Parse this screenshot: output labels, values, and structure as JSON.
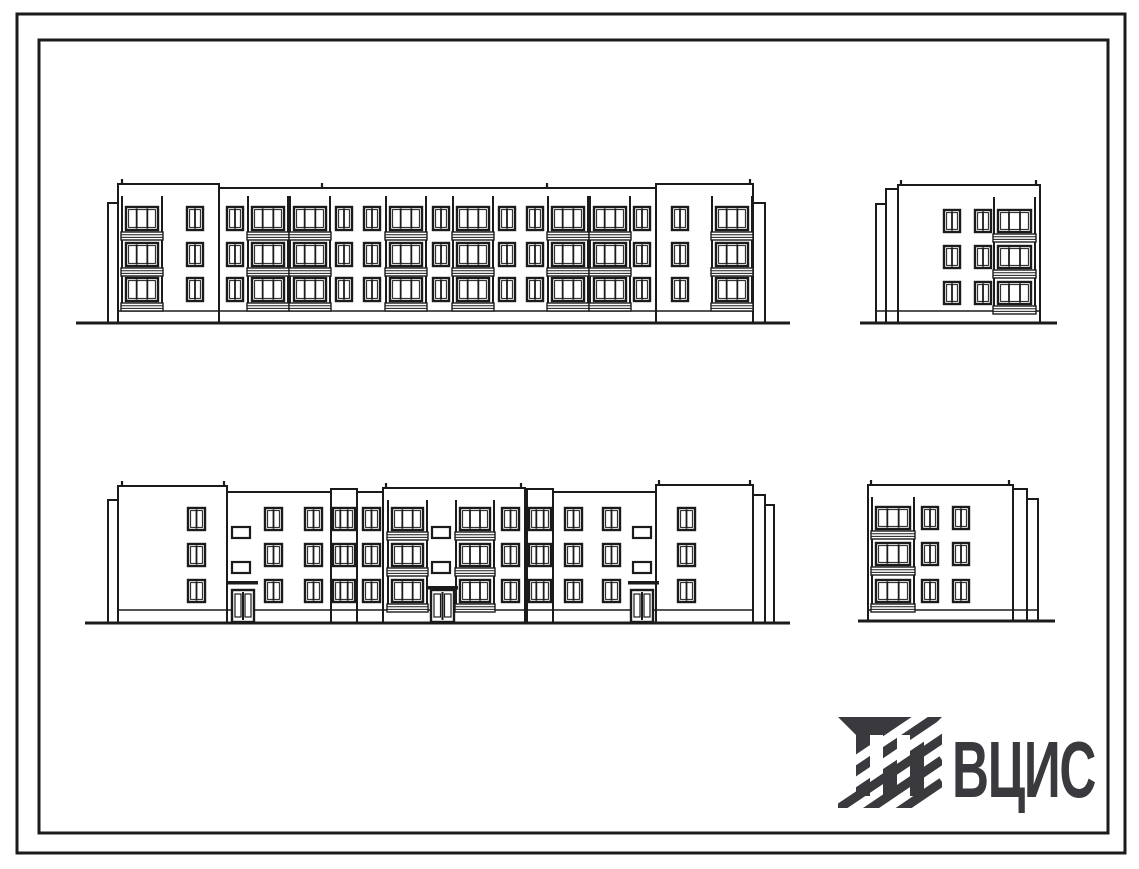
{
  "sheet": {
    "width": 1139,
    "height": 869,
    "background": "#ffffff"
  },
  "frame": {
    "outer": {
      "x": 17,
      "y": 14,
      "w": 1108,
      "h": 839,
      "stroke_width": 3
    },
    "inner": {
      "x": 39,
      "y": 40,
      "w": 1069,
      "h": 793,
      "stroke_width": 3
    }
  },
  "logo": {
    "text": "ВЦИС",
    "color": "#3a3a3e",
    "icon": "vcis-column-hatch-icon"
  },
  "drawing": {
    "line_color": "#1b1b1b",
    "elevations": [
      {
        "name": "front-elevation",
        "ground": {
          "x1": 76,
          "x2": 790,
          "y": 323
        },
        "rows": [
          207,
          243,
          278
        ],
        "win_h": 23,
        "win_w": 16,
        "plinth": {
          "x1": 118,
          "x2": 753,
          "y": 311
        },
        "col_top": 196,
        "blocks": [
          {
            "x": 108,
            "y": 203,
            "w": 10,
            "h": 120
          },
          {
            "x": 118,
            "y": 188,
            "w": 635,
            "h": 135
          },
          {
            "x": 118,
            "y": 184,
            "w": 101,
            "h": 139
          },
          {
            "x": 656,
            "y": 184,
            "w": 97,
            "h": 139
          },
          {
            "x": 753,
            "y": 203,
            "w": 12,
            "h": 120
          }
        ],
        "joints": [
          [
            219,
            188,
            311
          ],
          [
            656,
            188,
            311
          ]
        ],
        "ticks": [
          [
            122,
            184
          ],
          [
            322,
            188
          ],
          [
            547,
            188
          ],
          [
            750,
            184
          ]
        ],
        "items": [
          {
            "t": "bal",
            "x": 121,
            "w": 42
          },
          {
            "t": "win",
            "x": 187
          },
          {
            "t": "win",
            "x": 227
          },
          {
            "t": "bal",
            "x": 247,
            "w": 42
          },
          {
            "t": "bal",
            "x": 289,
            "w": 42
          },
          {
            "t": "win",
            "x": 336
          },
          {
            "t": "win",
            "x": 364
          },
          {
            "t": "bal",
            "x": 385,
            "w": 42
          },
          {
            "t": "win",
            "x": 433
          },
          {
            "t": "bal",
            "x": 452,
            "w": 42
          },
          {
            "t": "win",
            "x": 499
          },
          {
            "t": "win",
            "x": 527
          },
          {
            "t": "bal",
            "x": 547,
            "w": 42
          },
          {
            "t": "bal",
            "x": 589,
            "w": 42
          },
          {
            "t": "win",
            "x": 634
          },
          {
            "t": "win",
            "x": 672
          },
          {
            "t": "bal",
            "x": 711,
            "w": 42
          }
        ]
      },
      {
        "name": "side-elevation-top-right",
        "ground": {
          "x1": 860,
          "x2": 1057,
          "y": 323
        },
        "rows": [
          210,
          246,
          282
        ],
        "win_h": 22,
        "win_w": 16,
        "plinth": {
          "x1": 876,
          "x2": 1040,
          "y": 311
        },
        "col_top": 197,
        "blocks": [
          {
            "x": 876,
            "y": 204,
            "w": 11,
            "h": 119
          },
          {
            "x": 886,
            "y": 189,
            "w": 12,
            "h": 134
          },
          {
            "x": 898,
            "y": 185,
            "w": 142,
            "h": 138
          }
        ],
        "joints": [],
        "ticks": [
          [
            901,
            185
          ],
          [
            1036,
            185
          ]
        ],
        "items": [
          {
            "t": "win",
            "x": 944
          },
          {
            "t": "win",
            "x": 975
          },
          {
            "t": "bal",
            "x": 993,
            "w": 43
          }
        ]
      },
      {
        "name": "rear-elevation",
        "ground": {
          "x1": 85,
          "x2": 790,
          "y": 623
        },
        "rows": [
          508,
          544,
          580
        ],
        "win_h": 22,
        "win_w": 17,
        "sq_rows": [
          527,
          562
        ],
        "plinth": {
          "x1": 118,
          "x2": 753,
          "y": 610
        },
        "col_top": 500,
        "blocks": [
          {
            "x": 108,
            "y": 500,
            "w": 10,
            "h": 123
          },
          {
            "x": 118,
            "y": 492,
            "w": 635,
            "h": 131
          },
          {
            "x": 118,
            "y": 486,
            "w": 109,
            "h": 137
          },
          {
            "x": 331,
            "y": 489,
            "w": 26,
            "h": 134
          },
          {
            "x": 383,
            "y": 488,
            "w": 142,
            "h": 135
          },
          {
            "x": 527,
            "y": 489,
            "w": 26,
            "h": 134
          },
          {
            "x": 656,
            "y": 485,
            "w": 97,
            "h": 138
          },
          {
            "x": 753,
            "y": 495,
            "w": 12,
            "h": 128
          },
          {
            "x": 765,
            "y": 505,
            "w": 9,
            "h": 118
          }
        ],
        "joints": [],
        "ticks": [
          [
            122,
            486
          ],
          [
            224,
            486
          ],
          [
            386,
            488
          ],
          [
            521,
            488
          ],
          [
            659,
            485
          ],
          [
            750,
            485
          ]
        ],
        "items": [
          {
            "t": "win",
            "x": 188
          },
          {
            "t": "sq",
            "x": 232
          },
          {
            "t": "canopy",
            "x": 227,
            "w": 31,
            "y": 581
          },
          {
            "t": "door",
            "x": 232,
            "w": 22,
            "y": 590
          },
          {
            "t": "win",
            "x": 265
          },
          {
            "t": "win",
            "x": 305
          },
          {
            "t": "stair",
            "x": 333,
            "w": 22
          },
          {
            "t": "win",
            "x": 363
          },
          {
            "t": "bal",
            "x": 387,
            "w": 41
          },
          {
            "t": "sq",
            "x": 432
          },
          {
            "t": "canopy",
            "x": 426,
            "w": 32,
            "y": 586
          },
          {
            "t": "door",
            "x": 431,
            "w": 23,
            "y": 590
          },
          {
            "t": "bal",
            "x": 455,
            "w": 40
          },
          {
            "t": "win",
            "x": 502
          },
          {
            "t": "stair",
            "x": 529,
            "w": 22
          },
          {
            "t": "win",
            "x": 565
          },
          {
            "t": "win",
            "x": 603
          },
          {
            "t": "sq",
            "x": 633
          },
          {
            "t": "canopy",
            "x": 628,
            "w": 31,
            "y": 581
          },
          {
            "t": "door",
            "x": 631,
            "w": 22,
            "y": 590
          },
          {
            "t": "win",
            "x": 678
          }
        ]
      },
      {
        "name": "side-elevation-bottom-right",
        "ground": {
          "x1": 858,
          "x2": 1055,
          "y": 621
        },
        "rows": [
          507,
          543,
          580
        ],
        "win_h": 22,
        "win_w": 16,
        "plinth": {
          "x1": 868,
          "x2": 1038,
          "y": 610
        },
        "col_top": 497,
        "blocks": [
          {
            "x": 868,
            "y": 485,
            "w": 145,
            "h": 136
          },
          {
            "x": 1013,
            "y": 489,
            "w": 14,
            "h": 132
          },
          {
            "x": 1027,
            "y": 499,
            "w": 11,
            "h": 122
          }
        ],
        "joints": [],
        "ticks": [
          [
            871,
            485
          ],
          [
            1009,
            485
          ]
        ],
        "items": [
          {
            "t": "bal",
            "x": 871,
            "w": 44
          },
          {
            "t": "win",
            "x": 922
          },
          {
            "t": "win",
            "x": 953
          }
        ]
      }
    ]
  }
}
